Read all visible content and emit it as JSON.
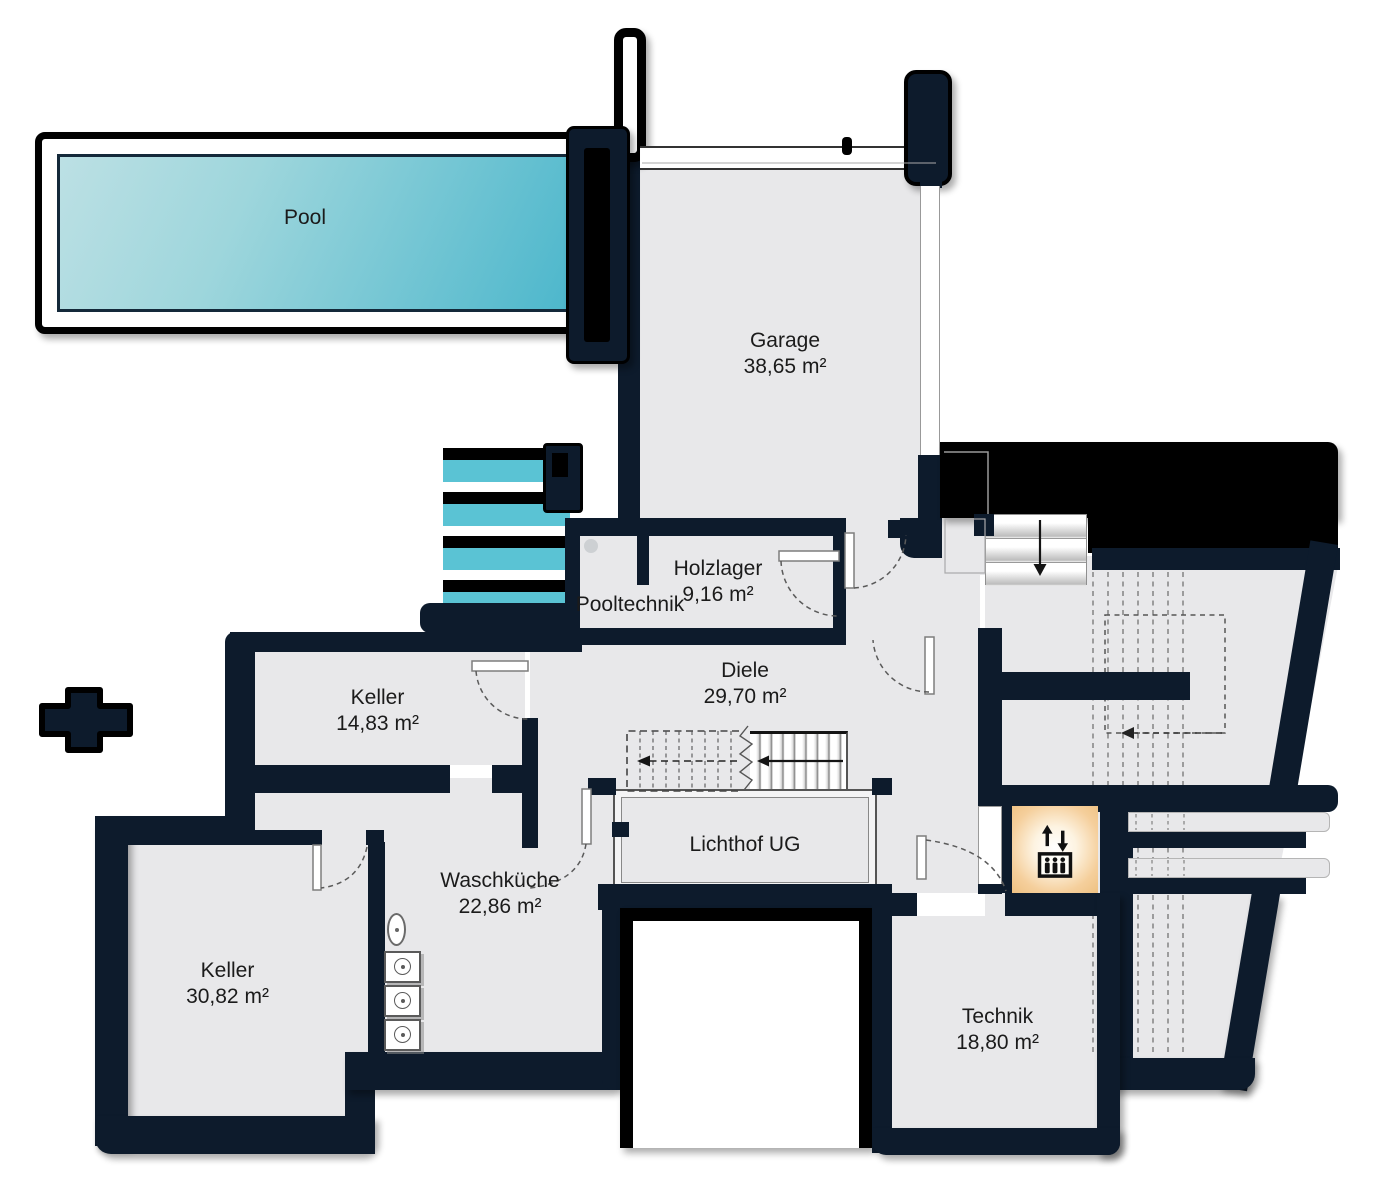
{
  "colors": {
    "wall_navy": "#0d1b2c",
    "outline_black": "#000000",
    "floor_gray": "#e8e8ea",
    "pool_light": "#b9dfe3",
    "pool_dark": "#4db7cc",
    "pool_step_teal": "#5ac3d4",
    "elevator_tint": "#f5cf9c"
  },
  "rooms": {
    "pool": {
      "name": "Pool"
    },
    "garage": {
      "name": "Garage",
      "area": "38,65 m²"
    },
    "holzlager": {
      "name": "Holzlager",
      "area": "9,16 m²"
    },
    "pooltechnik": {
      "name": "Pooltechnik"
    },
    "diele": {
      "name": "Diele",
      "area": "29,70 m²"
    },
    "keller_klein": {
      "name": "Keller",
      "area": "14,83 m²"
    },
    "lichthof": {
      "name": "Lichthof UG"
    },
    "waschkueche": {
      "name": "Waschküche",
      "area": "22,86 m²"
    },
    "keller_gross": {
      "name": "Keller",
      "area": "30,82 m²"
    },
    "technik": {
      "name": "Technik",
      "area": "18,80 m²"
    }
  },
  "icons": {
    "elevator": "elevator-icon",
    "chimney_cross": "chimney-cross-icon",
    "stair_direction": "arrow-icon"
  }
}
